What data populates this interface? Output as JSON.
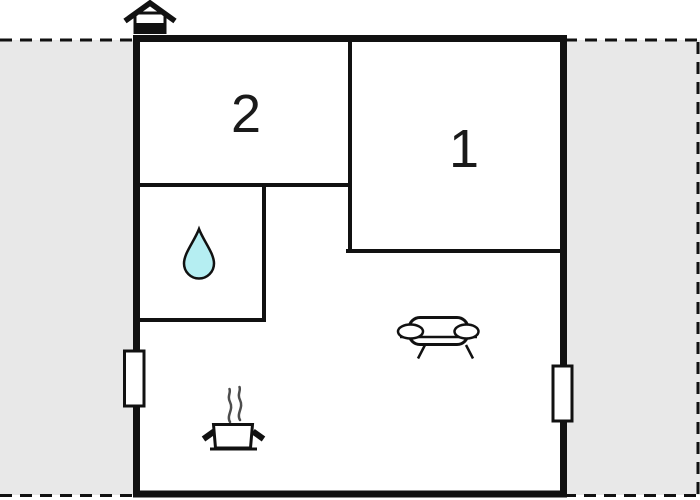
{
  "diagram_type": "floor-plan",
  "rooms": [
    {
      "id": "room-1",
      "label": "1"
    },
    {
      "id": "room-2",
      "label": "2"
    }
  ],
  "icons": {
    "entrance": "house-entrance-icon",
    "bathroom": "water-drop-icon",
    "kitchen": "cooking-pot-icon",
    "kitchen_steam": "steam-icon",
    "living": "sofa-icon",
    "window_left": "window-icon",
    "window_right": "window-icon"
  },
  "colors": {
    "wall": "#111111",
    "interior": "#ffffff",
    "outside_area": "#e8e8e8",
    "boundary_dash": "#111111",
    "water_drop_fill": "#b5eef2",
    "steam": "#4d4d4d"
  }
}
